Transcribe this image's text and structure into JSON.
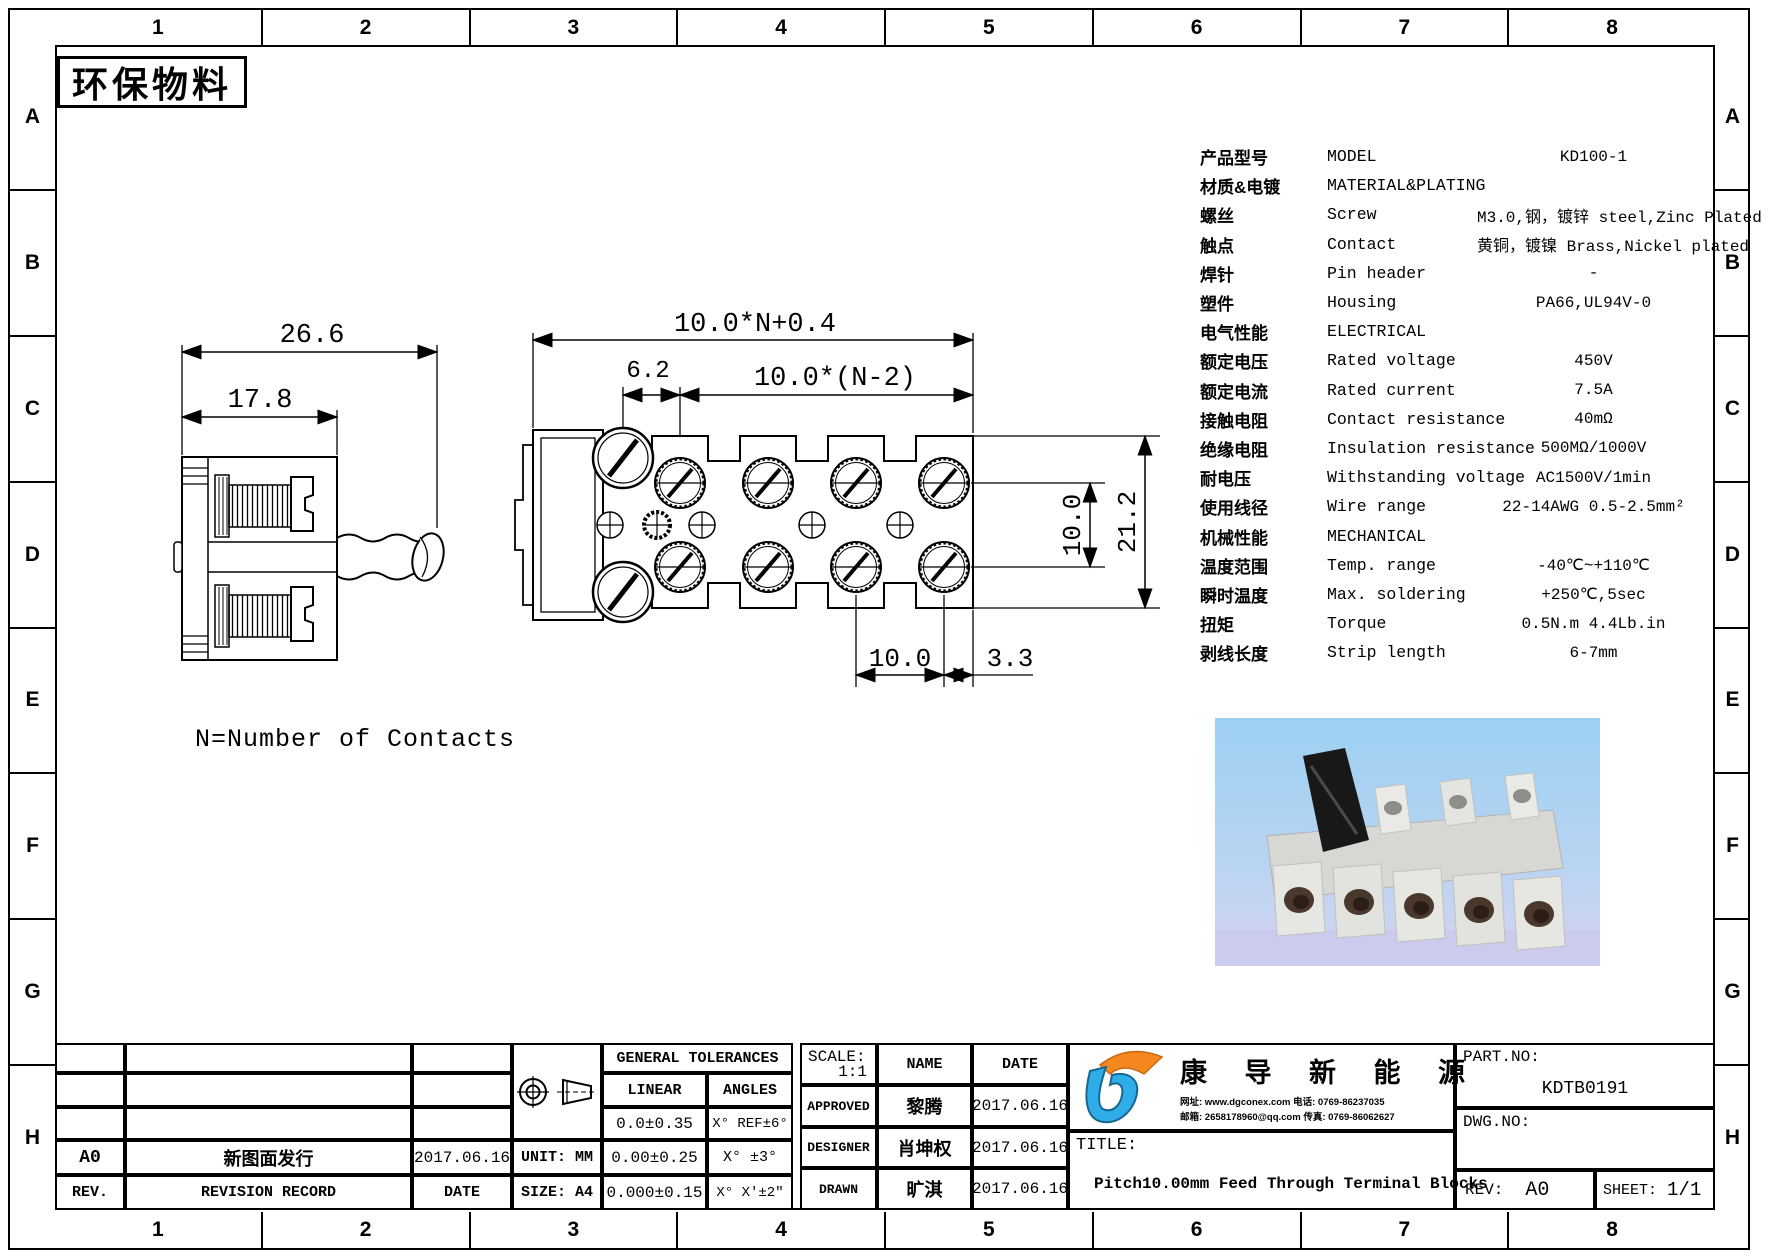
{
  "zones": {
    "cols": [
      "1",
      "2",
      "3",
      "4",
      "5",
      "6",
      "7",
      "8"
    ],
    "rows": [
      "A",
      "B",
      "C",
      "D",
      "E",
      "F",
      "G",
      "H"
    ]
  },
  "stamp": {
    "text": "环保物料"
  },
  "note": {
    "text": "N=Number of Contacts"
  },
  "side_view": {
    "dim_overall": "26.6",
    "dim_body": "17.8"
  },
  "top_view": {
    "dim_overall": "10.0*N+0.4",
    "dim_span": "10.0*(N-2)",
    "dim_offset": "6.2",
    "dim_row_gap": "10.0",
    "dim_height": "21.2",
    "dim_pitch": "10.0",
    "dim_edge": "3.3"
  },
  "spec": {
    "rows": [
      {
        "zh": "产品型号",
        "en": "MODEL",
        "val": "KD100-1"
      },
      {
        "zh": "材质&电镀",
        "en": "MATERIAL&PLATING",
        "val": ""
      },
      {
        "zh": "螺丝",
        "en": "Screw",
        "val": "M3.0,钢，镀锌 steel,Zinc Plated"
      },
      {
        "zh": "触点",
        "en": "Contact",
        "val": "黄铜，镀镍 Brass,Nickel plated"
      },
      {
        "zh": "焊针",
        "en": "Pin header",
        "val": "-"
      },
      {
        "zh": "塑件",
        "en": "Housing",
        "val": "PA66,UL94V-0"
      },
      {
        "zh": "电气性能",
        "en": "ELECTRICAL",
        "val": ""
      },
      {
        "zh": "额定电压",
        "en": "Rated voltage",
        "val": "450V"
      },
      {
        "zh": "额定电流",
        "en": "Rated current",
        "val": "7.5A"
      },
      {
        "zh": "接触电阻",
        "en": "Contact resistance",
        "val": "40mΩ"
      },
      {
        "zh": "绝缘电阻",
        "en": "Insulation resistance",
        "val": "500MΩ/1000V"
      },
      {
        "zh": "耐电压",
        "en": "Withstanding voltage",
        "val": "AC1500V/1min"
      },
      {
        "zh": "使用线径",
        "en": "Wire range",
        "val": "22-14AWG 0.5-2.5mm²"
      },
      {
        "zh": "机械性能",
        "en": "MECHANICAL",
        "val": ""
      },
      {
        "zh": "温度范围",
        "en": "Temp. range",
        "val": "-40℃~+110℃"
      },
      {
        "zh": "瞬时温度",
        "en": "Max. soldering",
        "val": "+250℃,5sec"
      },
      {
        "zh": "扭矩",
        "en": "Torque",
        "val": "0.5N.m 4.4Lb.in"
      },
      {
        "zh": "剥线长度",
        "en": "Strip length",
        "val": "6-7mm"
      }
    ]
  },
  "title_block": {
    "revision": {
      "rev": "A0",
      "record": "新图面发行",
      "date": "2017.06.16",
      "rev_label": "REV.",
      "record_label": "REVISION RECORD",
      "date_label": "DATE",
      "unit": "UNIT: MM",
      "size": "SIZE: A4"
    },
    "tolerances": {
      "header": "GENERAL TOLERANCES",
      "linear_label": "LINEAR",
      "angles_label": "ANGLES",
      "rows": [
        {
          "linear": "0.0±0.35",
          "angles": "X° REF±6°"
        },
        {
          "linear": "0.00±0.25",
          "angles": "X° ±3°"
        },
        {
          "linear": "0.000±0.15",
          "angles": "X° X'±2\""
        }
      ]
    },
    "approval": {
      "scale_label": "SCALE:",
      "scale": "1:1",
      "name_label": "NAME",
      "date_label": "DATE",
      "rows": [
        {
          "role": "APPROVED",
          "name": "黎腾",
          "date": "2017.06.16"
        },
        {
          "role": "DESIGNER",
          "name": "肖坤权",
          "date": "2017.06.16"
        },
        {
          "role": "DRAWN",
          "name": "旷淇",
          "date": "2017.06.16"
        }
      ]
    },
    "company": {
      "name": "康 导 新 能 源",
      "contact1": "网址: www.dgconex.com  电话: 0769-86237035",
      "contact2": "邮箱: 2658178960@qq.com 传真: 0769-86062627"
    },
    "doc": {
      "title_label": "TITLE:",
      "title": "Pitch10.00mm Feed Through Terminal Blocks",
      "part_label": "PART.NO:",
      "part_no": "KDTB0191",
      "dwg_label": "DWG.NO:",
      "rev_label": "REV:",
      "rev": "A0",
      "sheet_label": "SHEET:",
      "sheet": "1/1"
    }
  },
  "colors": {
    "logo_blue": "#2fade8",
    "logo_orange": "#f5871f",
    "sky": "#9cd0f2"
  }
}
